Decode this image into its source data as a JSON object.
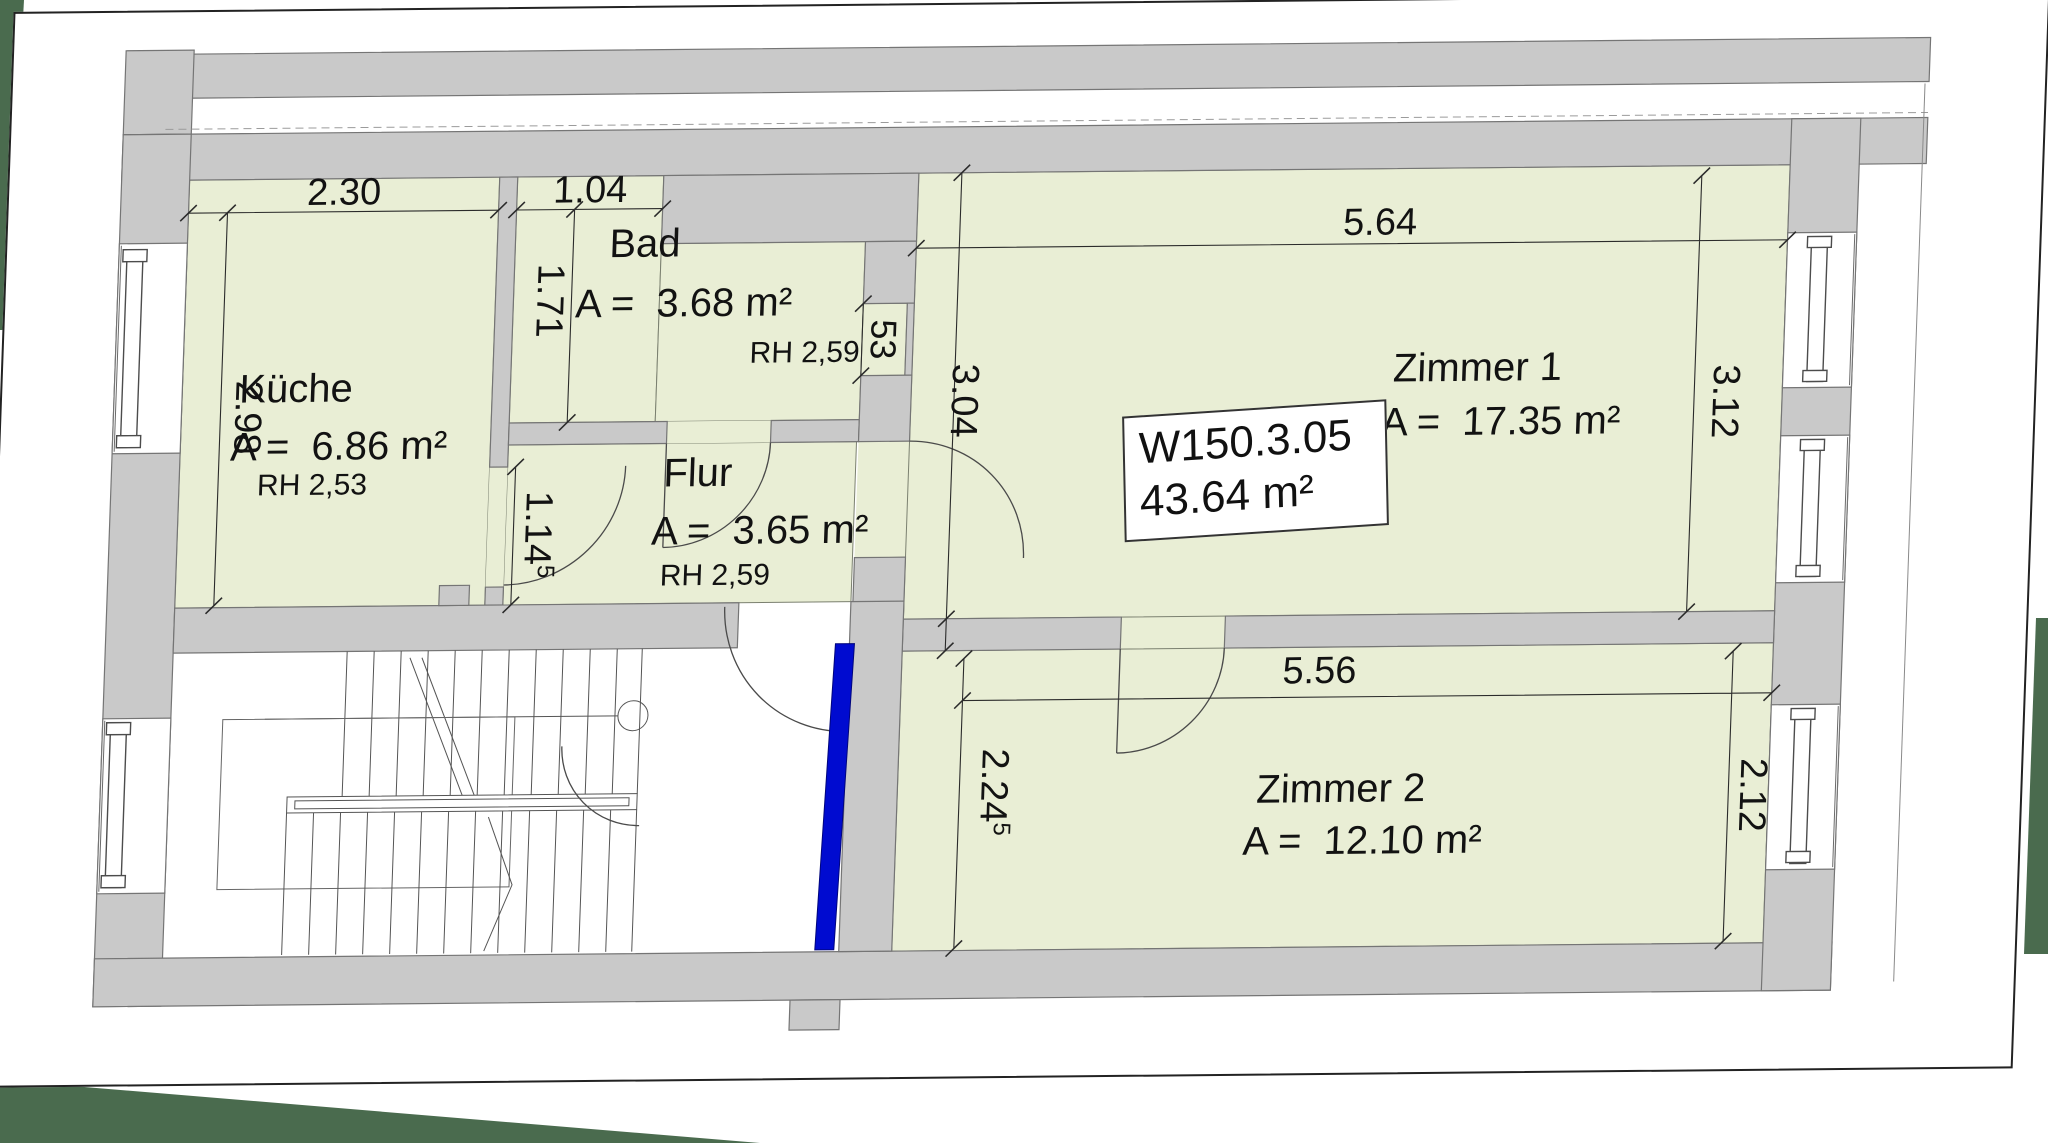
{
  "apartment_label": {
    "id": "W150.3.05",
    "area": "43.64 m²"
  },
  "rooms": {
    "kueche": {
      "name": "Küche",
      "area": "A =  6.86 m²",
      "rh": "RH 2,53"
    },
    "bad": {
      "name": "Bad",
      "area": "A =  3.68 m²",
      "rh": "RH 2,59"
    },
    "flur": {
      "name": "Flur",
      "area": "A =  3.65 m²",
      "rh": "RH 2,59"
    },
    "zimmer1": {
      "name": "Zimmer 1",
      "area": "A =  17.35 m²"
    },
    "zimmer2": {
      "name": "Zimmer 2",
      "area": "A =  12.10 m²"
    }
  },
  "dimensions": {
    "kueche_width": "2.30",
    "kueche_depth": "2.98",
    "bad_width": "1.04",
    "bad_depth": "1.71",
    "niche_width": "53",
    "flur_clear": {
      "value": "1.14",
      "sup": "5"
    },
    "zimmer1_width": "5.64",
    "zimmer1_depth_inner": "3.04",
    "zimmer1_depth_window": "3.12",
    "zimmer2_width": "5.56",
    "zimmer2_depth_inner": {
      "value": "2.24",
      "sup": "5"
    },
    "zimmer2_depth_window": "2.12"
  },
  "colors": {
    "room_fill": "#e9eed5",
    "wall_fill": "#c9c9c9",
    "highlight_blue": "#000bd0",
    "vegetation_green": "#4a6b4e",
    "sheet": "#ffffff"
  }
}
